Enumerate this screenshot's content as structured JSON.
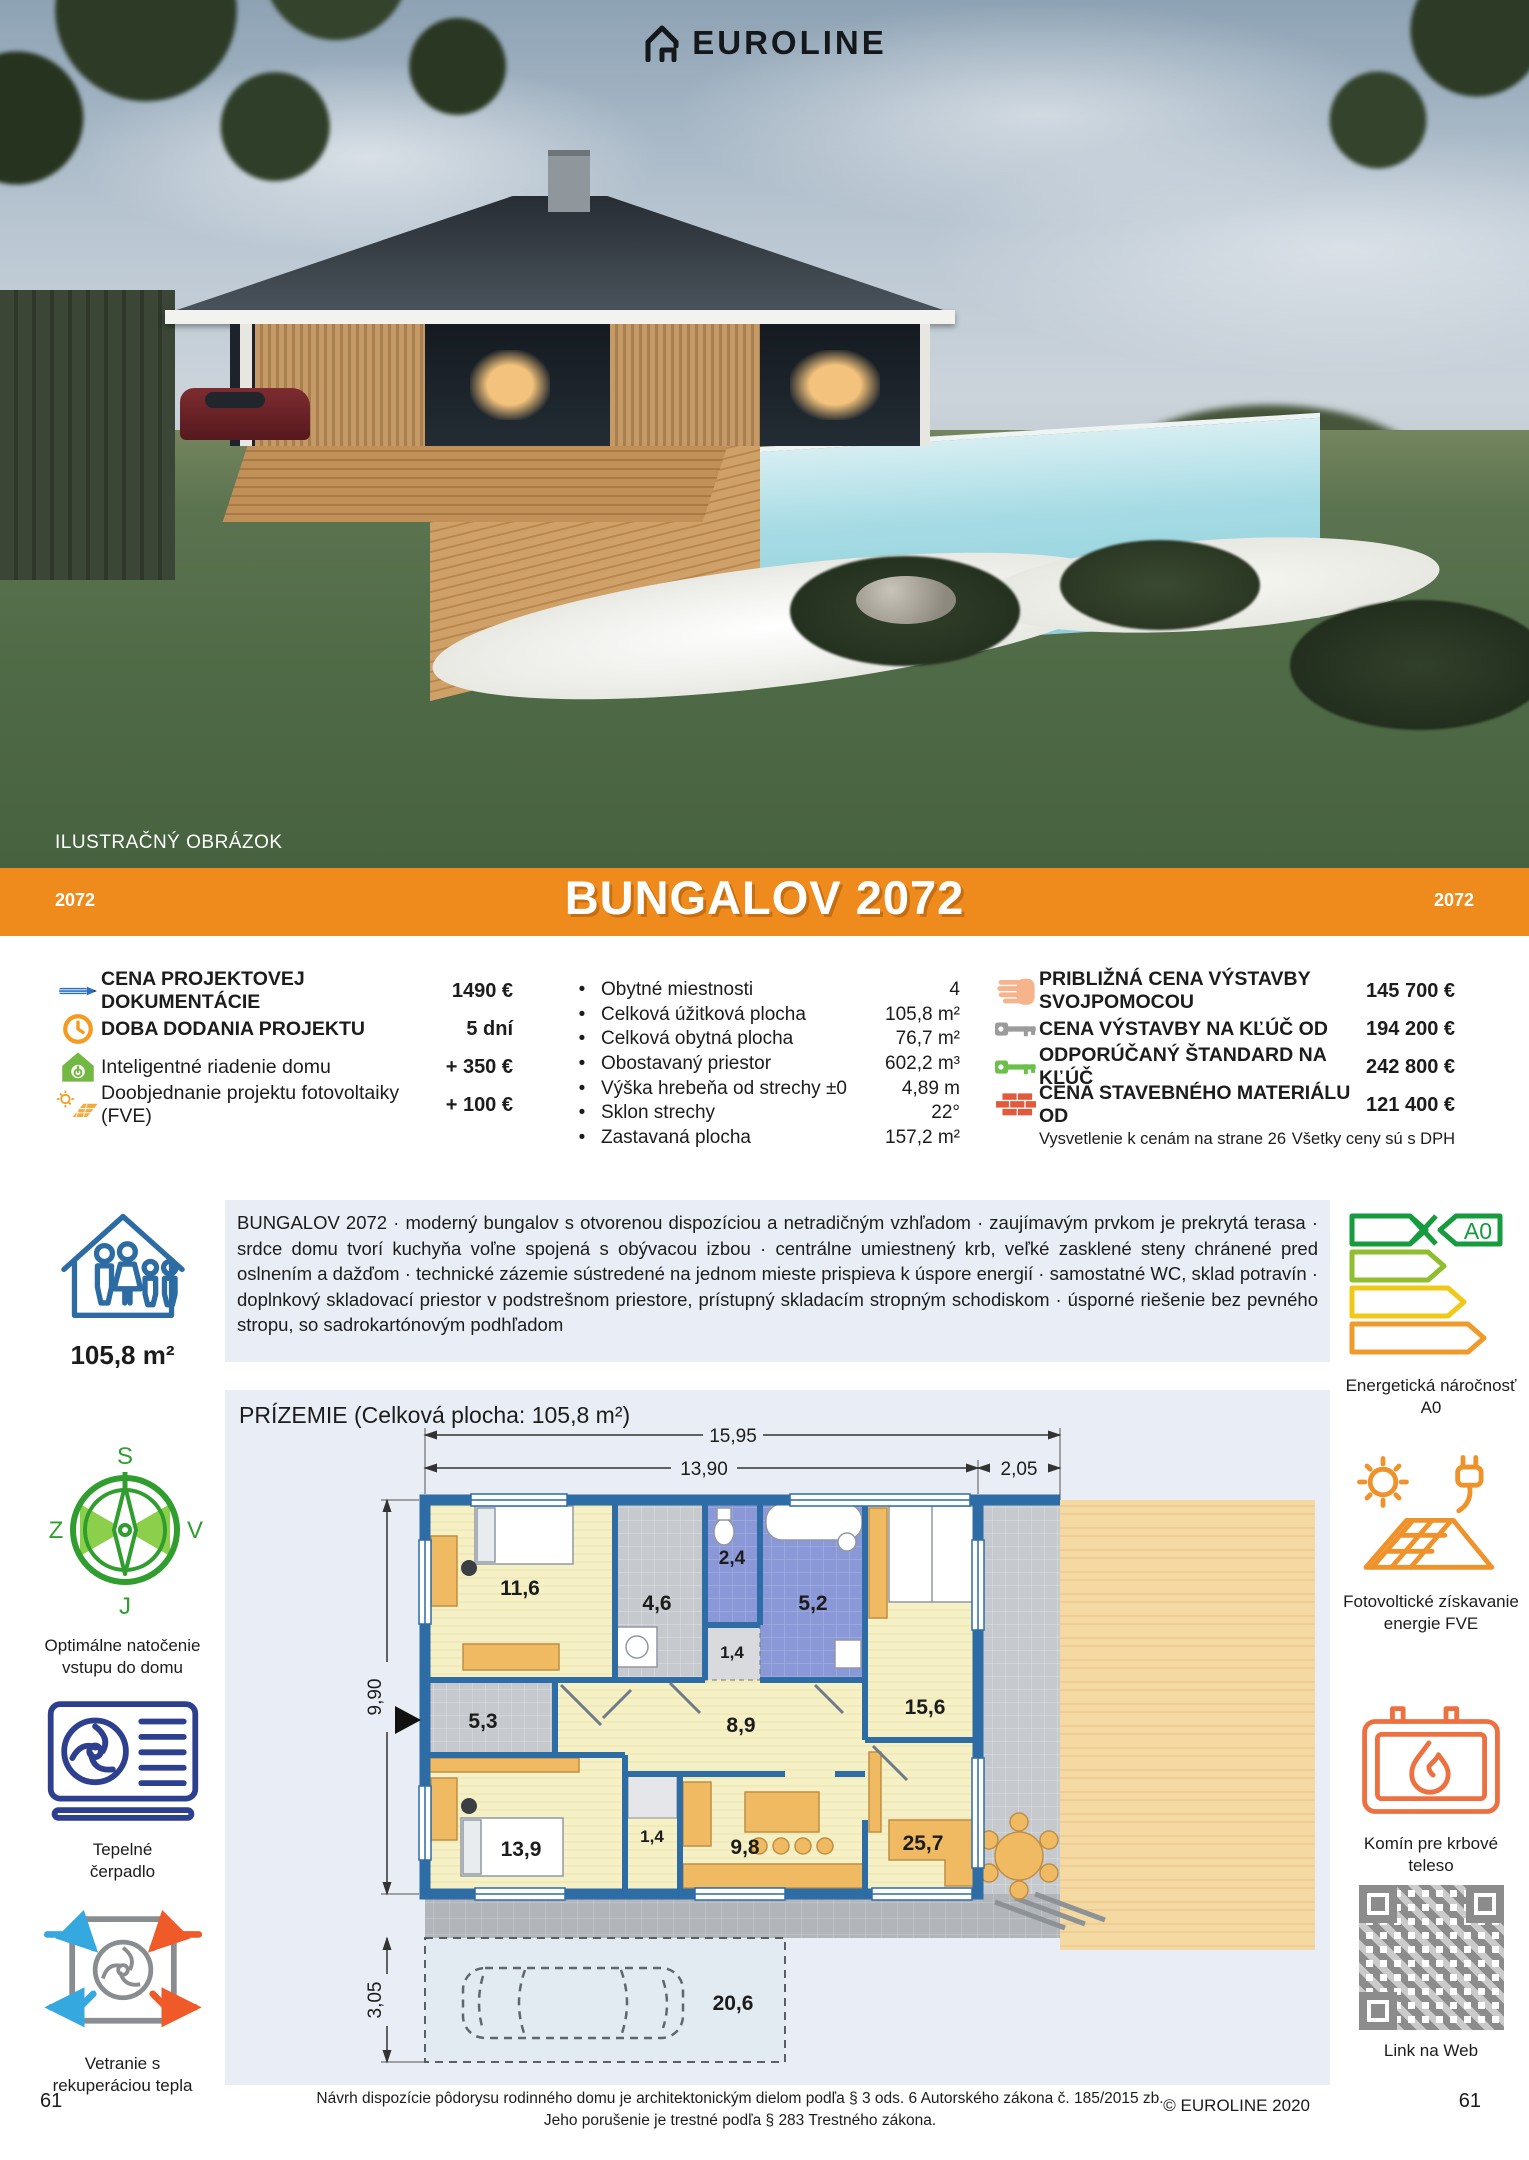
{
  "brand": {
    "logo_text": "EUROLINE"
  },
  "photo": {
    "caption": "ILUSTRAČNÝ OBRÁZOK"
  },
  "banner": {
    "title": "BUNGALOV 2072",
    "code_left": "2072",
    "code_right": "2072",
    "color": "#EF8A1D"
  },
  "pricing_left": {
    "rows": [
      {
        "icon": "pencil-icon",
        "label": "CENA PROJEKTOVEJ DOKUMENTÁCIE",
        "value": "1490 €"
      },
      {
        "icon": "clock-icon",
        "label": "DOBA DODANIA PROJEKTU",
        "value": "5 dní"
      },
      {
        "icon": "smart-home-icon",
        "label": "Inteligentné riadenie domu",
        "value": "+ 350 €"
      },
      {
        "icon": "solar-addon-icon",
        "label": "Doobjednanie projektu fotovoltaiky (FVE)",
        "value": "+ 100 €"
      }
    ]
  },
  "specs": {
    "rows": [
      {
        "label": "Obytné miestnosti",
        "value": "4"
      },
      {
        "label": "Celková úžitková plocha",
        "value": "105,8 m²"
      },
      {
        "label": "Celková obytná plocha",
        "value": "76,7 m²"
      },
      {
        "label": "Obostavaný priestor",
        "value": "602,2 m³"
      },
      {
        "label": "Výška hrebeňa od strechy ±0",
        "value": "4,89 m"
      },
      {
        "label": "Sklon strechy",
        "value": "22°"
      },
      {
        "label": "Zastavaná plocha",
        "value": "157,2 m²"
      }
    ]
  },
  "pricing_right": {
    "rows": [
      {
        "icon": "hand-icon",
        "label": "PRIBLIŽNÁ CENA VÝSTAVBY SVOJPOMOCOU",
        "value": "145 700 €"
      },
      {
        "icon": "key-gray-icon",
        "label": "CENA VÝSTAVBY NA KĽÚČ OD",
        "value": "194 200 €"
      },
      {
        "icon": "key-green-icon",
        "label": "ODPORÚČANÝ ŠTANDARD NA KĽÚČ",
        "value": "242 800 €"
      },
      {
        "icon": "bricks-icon",
        "label": "CENA STAVEBNÉHO MATERIÁLU OD",
        "value": "121 400 €"
      }
    ],
    "note_left": "Vysvetlenie k cenám na strane 26",
    "note_right": "Všetky ceny sú s DPH"
  },
  "description": "BUNGALOV 2072 · moderný bungalov s otvorenou dispozíciou a netradičným vzhľadom · zaujímavým prvkom je prekrytá terasa · srdce domu tvorí kuchyňa voľne spojená s obývacou izbou · centrálne umiestnený krb, veľké zasklené steny chránené pred oslnením a dažďom · technické zázemie sústredené na jednom mieste prispieva k úspore energií · samostatné WC, sklad potravín · doplnkový skladovací priestor v podstrešnom priestore, prístupný skladacím stropným schodiskom ·  úsporné riešenie bez pevného stropu, so sadrokartónovým podhľadom",
  "area_badge": "105,8 m²",
  "left_features": [
    {
      "icon": "house-family-icon",
      "caption": ""
    },
    {
      "icon": "compass-icon",
      "caption": "Optimálne natočenie vstupu do domu",
      "letters": {
        "n": "S",
        "s": "J",
        "w": "Z",
        "e": "V"
      }
    },
    {
      "icon": "heat-pump-icon",
      "caption": "Tepelné čerpadlo"
    },
    {
      "icon": "ventilation-icon",
      "caption": "Vetranie s rekuperáciou tepla"
    }
  ],
  "right_features": [
    {
      "icon": "energy-label-icon",
      "caption": "Energetická náročnosť A0",
      "badge": "A0"
    },
    {
      "icon": "photovoltaic-icon",
      "caption": "Fotovoltické získavanie energie FVE"
    },
    {
      "icon": "fireplace-icon",
      "caption": "Komín pre krbové teleso"
    },
    {
      "icon": "qr-code",
      "caption": "Link na Web"
    }
  ],
  "plan": {
    "title": "PRÍZEMIE (Celková plocha: 105,8 m²)",
    "dims": {
      "top_total": "15,95",
      "top_house": "13,90",
      "top_terrace": "2,05",
      "left_house": "9,90",
      "left_parking": "3,05"
    },
    "rooms": [
      "11,6",
      "4,6",
      "2,4",
      "5,2",
      "1,4",
      "15,6",
      "5,3",
      "8,9",
      "9,8",
      "25,7",
      "13,9",
      "1,4",
      "20,6"
    ]
  },
  "footer": {
    "legal1": "Návrh dispozície pôdorysu rodinného domu je architektonickým dielom podľa § 3 ods. 6 Autorského zákona č. 185/2015 zb.",
    "legal2": "Jeho porušenie je trestné podľa § 283 Trestného zákona.",
    "copyright": "© EUROLINE 2020",
    "page_left": "61",
    "page_right": "61"
  }
}
